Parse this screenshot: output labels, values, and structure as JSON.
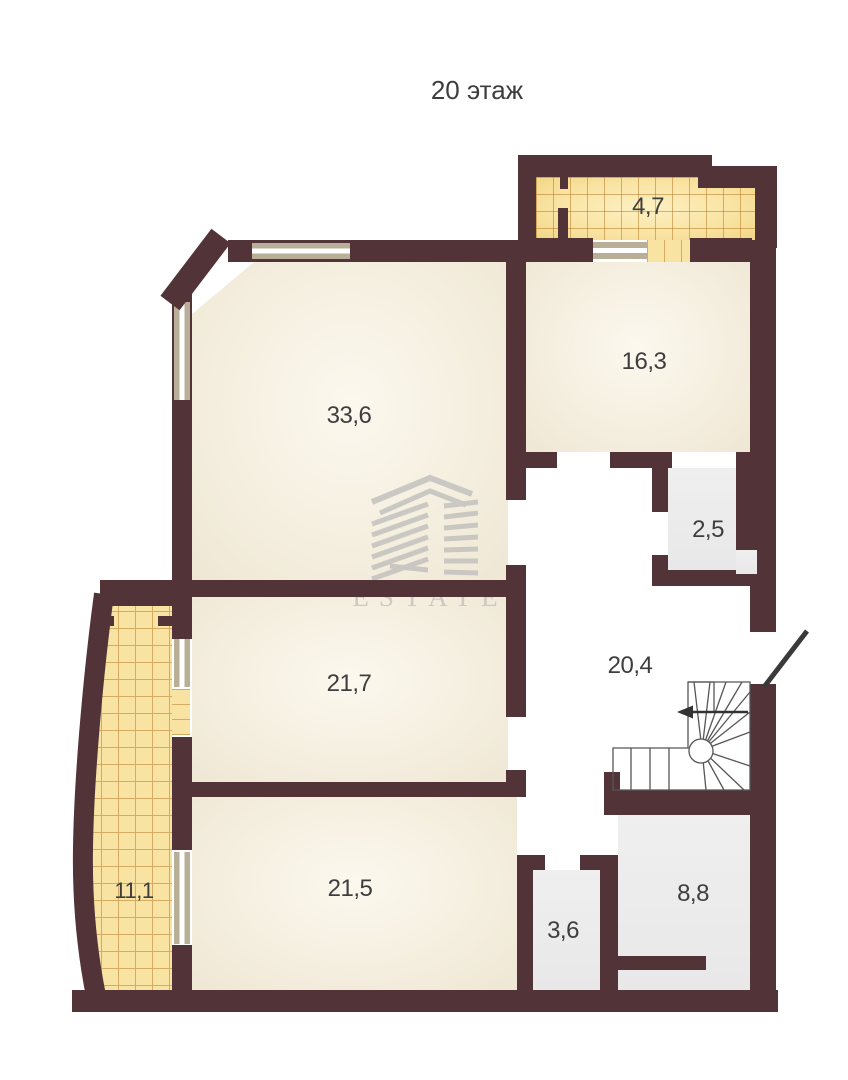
{
  "title": "20 этаж",
  "watermark": {
    "brand": "ESTATE"
  },
  "colors": {
    "wall": "#523438",
    "room_fill": "#f3ecdc",
    "service_fill": "#e9e9ea",
    "balcony_tile_fill": "#f9e3a2",
    "balcony_tile_grid": "#c08a34",
    "window_frame": "#b9ae97",
    "label_text": "#3e3e3e",
    "watermark_gray": "#c8c6c1"
  },
  "floor_plan": {
    "floor_label": "20 этаж",
    "rooms": [
      {
        "id": "balcony-top",
        "area_label": "4,7",
        "type": "balcony"
      },
      {
        "id": "room-16-3",
        "area_label": "16,3",
        "type": "room"
      },
      {
        "id": "living-33-6",
        "area_label": "33,6",
        "type": "room"
      },
      {
        "id": "storage-2-5",
        "area_label": "2,5",
        "type": "service"
      },
      {
        "id": "hall-20-4",
        "area_label": "20,4",
        "type": "hall"
      },
      {
        "id": "room-21-7",
        "area_label": "21,7",
        "type": "room"
      },
      {
        "id": "room-21-5",
        "area_label": "21,5",
        "type": "room"
      },
      {
        "id": "balcony-left",
        "area_label": "11,1",
        "type": "balcony"
      },
      {
        "id": "wc-3-6",
        "area_label": "3,6",
        "type": "service"
      },
      {
        "id": "room-8-8",
        "area_label": "8,8",
        "type": "service"
      }
    ],
    "features": [
      "winder-staircase",
      "entrance-door-swing",
      "direction-arrow"
    ]
  }
}
